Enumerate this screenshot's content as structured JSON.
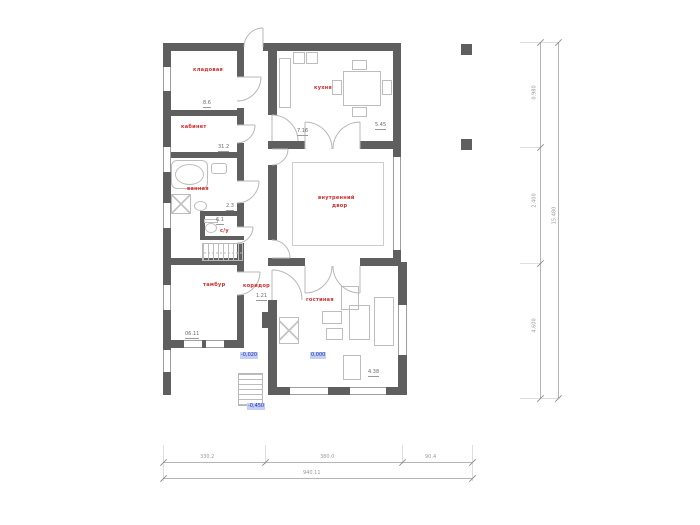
{
  "plan": {
    "rooms": [
      {
        "id": "pantry",
        "label": "кладовая"
      },
      {
        "id": "study",
        "label": "кабинет"
      },
      {
        "id": "bathroom",
        "label": "ванная"
      },
      {
        "id": "wc",
        "label": "с/у"
      },
      {
        "id": "vestibule",
        "label": "тамбур"
      },
      {
        "id": "corridor",
        "label": "коридор"
      },
      {
        "id": "living-room",
        "label": "гостиная"
      },
      {
        "id": "kitchen",
        "label": "кухня"
      },
      {
        "id": "courtyard-line1",
        "label": "внутренний"
      },
      {
        "id": "courtyard-line2",
        "label": "двор"
      }
    ],
    "areas": [
      "8.6",
      "31.2",
      "2.3",
      "6.1",
      "1.21",
      "7.16",
      "5.45",
      "06.11",
      "4.38"
    ],
    "levels": [
      "-0,020",
      "0,000",
      "-0,450"
    ],
    "dims_bottom": [
      "330.2",
      "380.0",
      "90.4"
    ],
    "dims_bottom_total": "940.11",
    "dims_right": [
      "0.980",
      "2.400",
      "4.600"
    ],
    "dims_right_total": "15.480",
    "colors": {
      "wall": "#5f5f5f",
      "room_label": "#d42b2b",
      "level_label": "#1d2fb8",
      "dim": "#9a9a9a"
    }
  }
}
